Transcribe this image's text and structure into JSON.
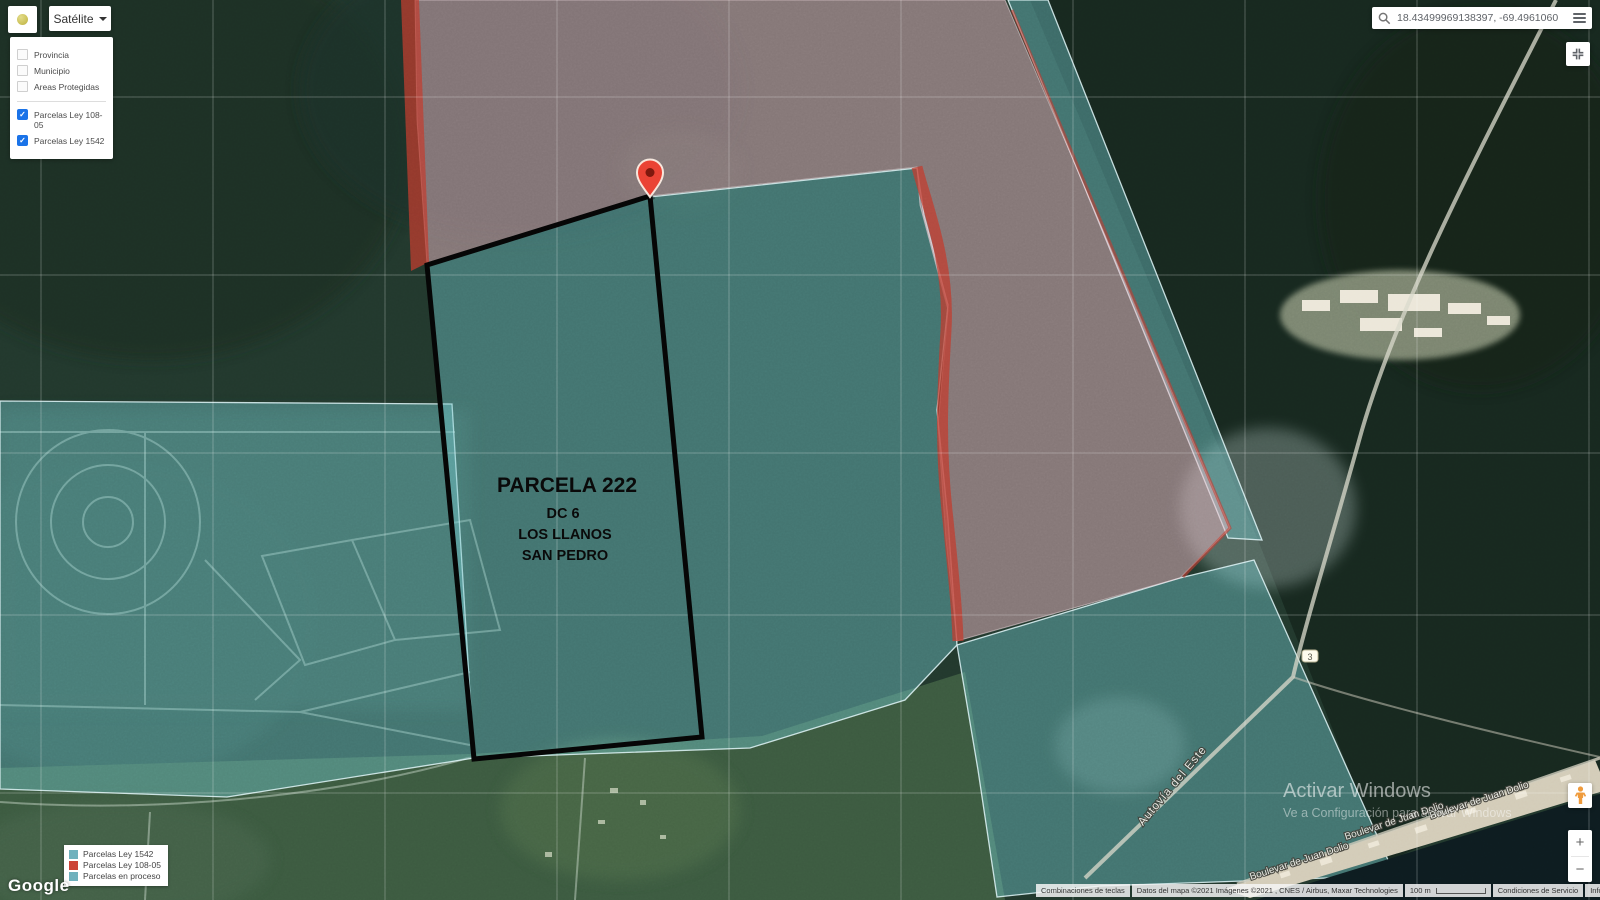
{
  "map_type_button": {
    "label": "Satélite"
  },
  "layers_panel": {
    "checkmark": "✓",
    "unchecked_items": [
      {
        "label": "Provincia"
      },
      {
        "label": "Municipio"
      },
      {
        "label": "Areas Protegidas"
      }
    ],
    "checked_items": [
      {
        "label": "Parcelas Ley 108-05"
      },
      {
        "label": "Parcelas Ley 1542"
      }
    ]
  },
  "search": {
    "value": "18.43499969138397, -69.4961060"
  },
  "parcel_label": {
    "title": "PARCELA 222",
    "line1": "DC 6",
    "line2": "LOS LLANOS",
    "line3": "SAN PEDRO"
  },
  "map_labels": {
    "highway": "Autovía del Este",
    "boulevards": [
      "Boulevar de Juan Dolio",
      "Boulevar de Juan Dolio",
      "Boulevar de Juan Dolio"
    ],
    "route_shield": "3"
  },
  "legend": {
    "items": [
      {
        "label": "Parcelas Ley 1542",
        "color": "#6fb1bd"
      },
      {
        "label": "Parcelas Ley 108-05",
        "color": "#cc4437"
      },
      {
        "label": "Parcelas en proceso",
        "color": "#6fb1bd"
      }
    ]
  },
  "watermark": {
    "line1": "Activar Windows",
    "line2": "Ve a Configuración para activar Windows"
  },
  "google_logo": "Google",
  "attribution": {
    "shortcuts": "Combinaciones de teclas",
    "map_data": "Datos del mapa ©2021 Imágenes ©2021 , CNES / Airbus, Maxar Technologies",
    "scale": "100 m",
    "terms": "Condiciones de Servicio",
    "report": "Informar un error en el mapa"
  },
  "zoom_control": {
    "zoom_in": "+",
    "zoom_out": "−"
  },
  "colors": {
    "parcel_teal_fill": "#73c8cd",
    "parcel_pink_fill": "#e7b6c1",
    "parcel_red": "#c23b2e",
    "marker_red": "#ea4335",
    "check_blue": "#1a73e8"
  }
}
